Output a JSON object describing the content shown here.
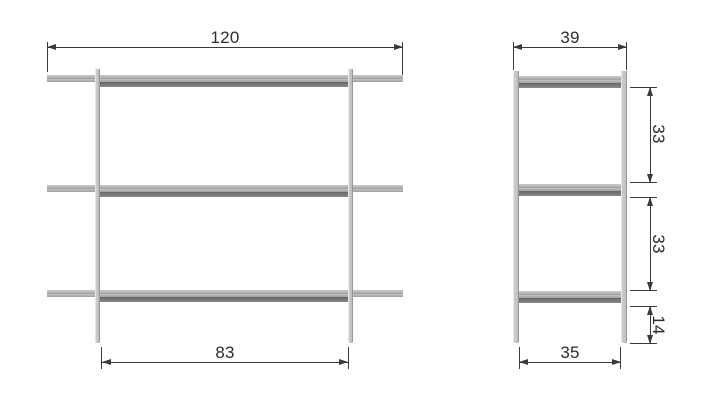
{
  "colors": {
    "line": "#3a3a3a",
    "text": "#2d2d2d",
    "shelf_light": "#b2b2b2",
    "shelf_dark": "#7c7c7c",
    "leg": "#c7c7c7",
    "background": "#ffffff"
  },
  "front_view": {
    "dim_overall_width": "120",
    "dim_leg_span": "83"
  },
  "side_view": {
    "dim_overall_depth": "39",
    "dim_shelf_gap_upper": "33",
    "dim_shelf_gap_lower": "33",
    "dim_bottom_clearance": "14",
    "dim_leg_span": "35"
  }
}
